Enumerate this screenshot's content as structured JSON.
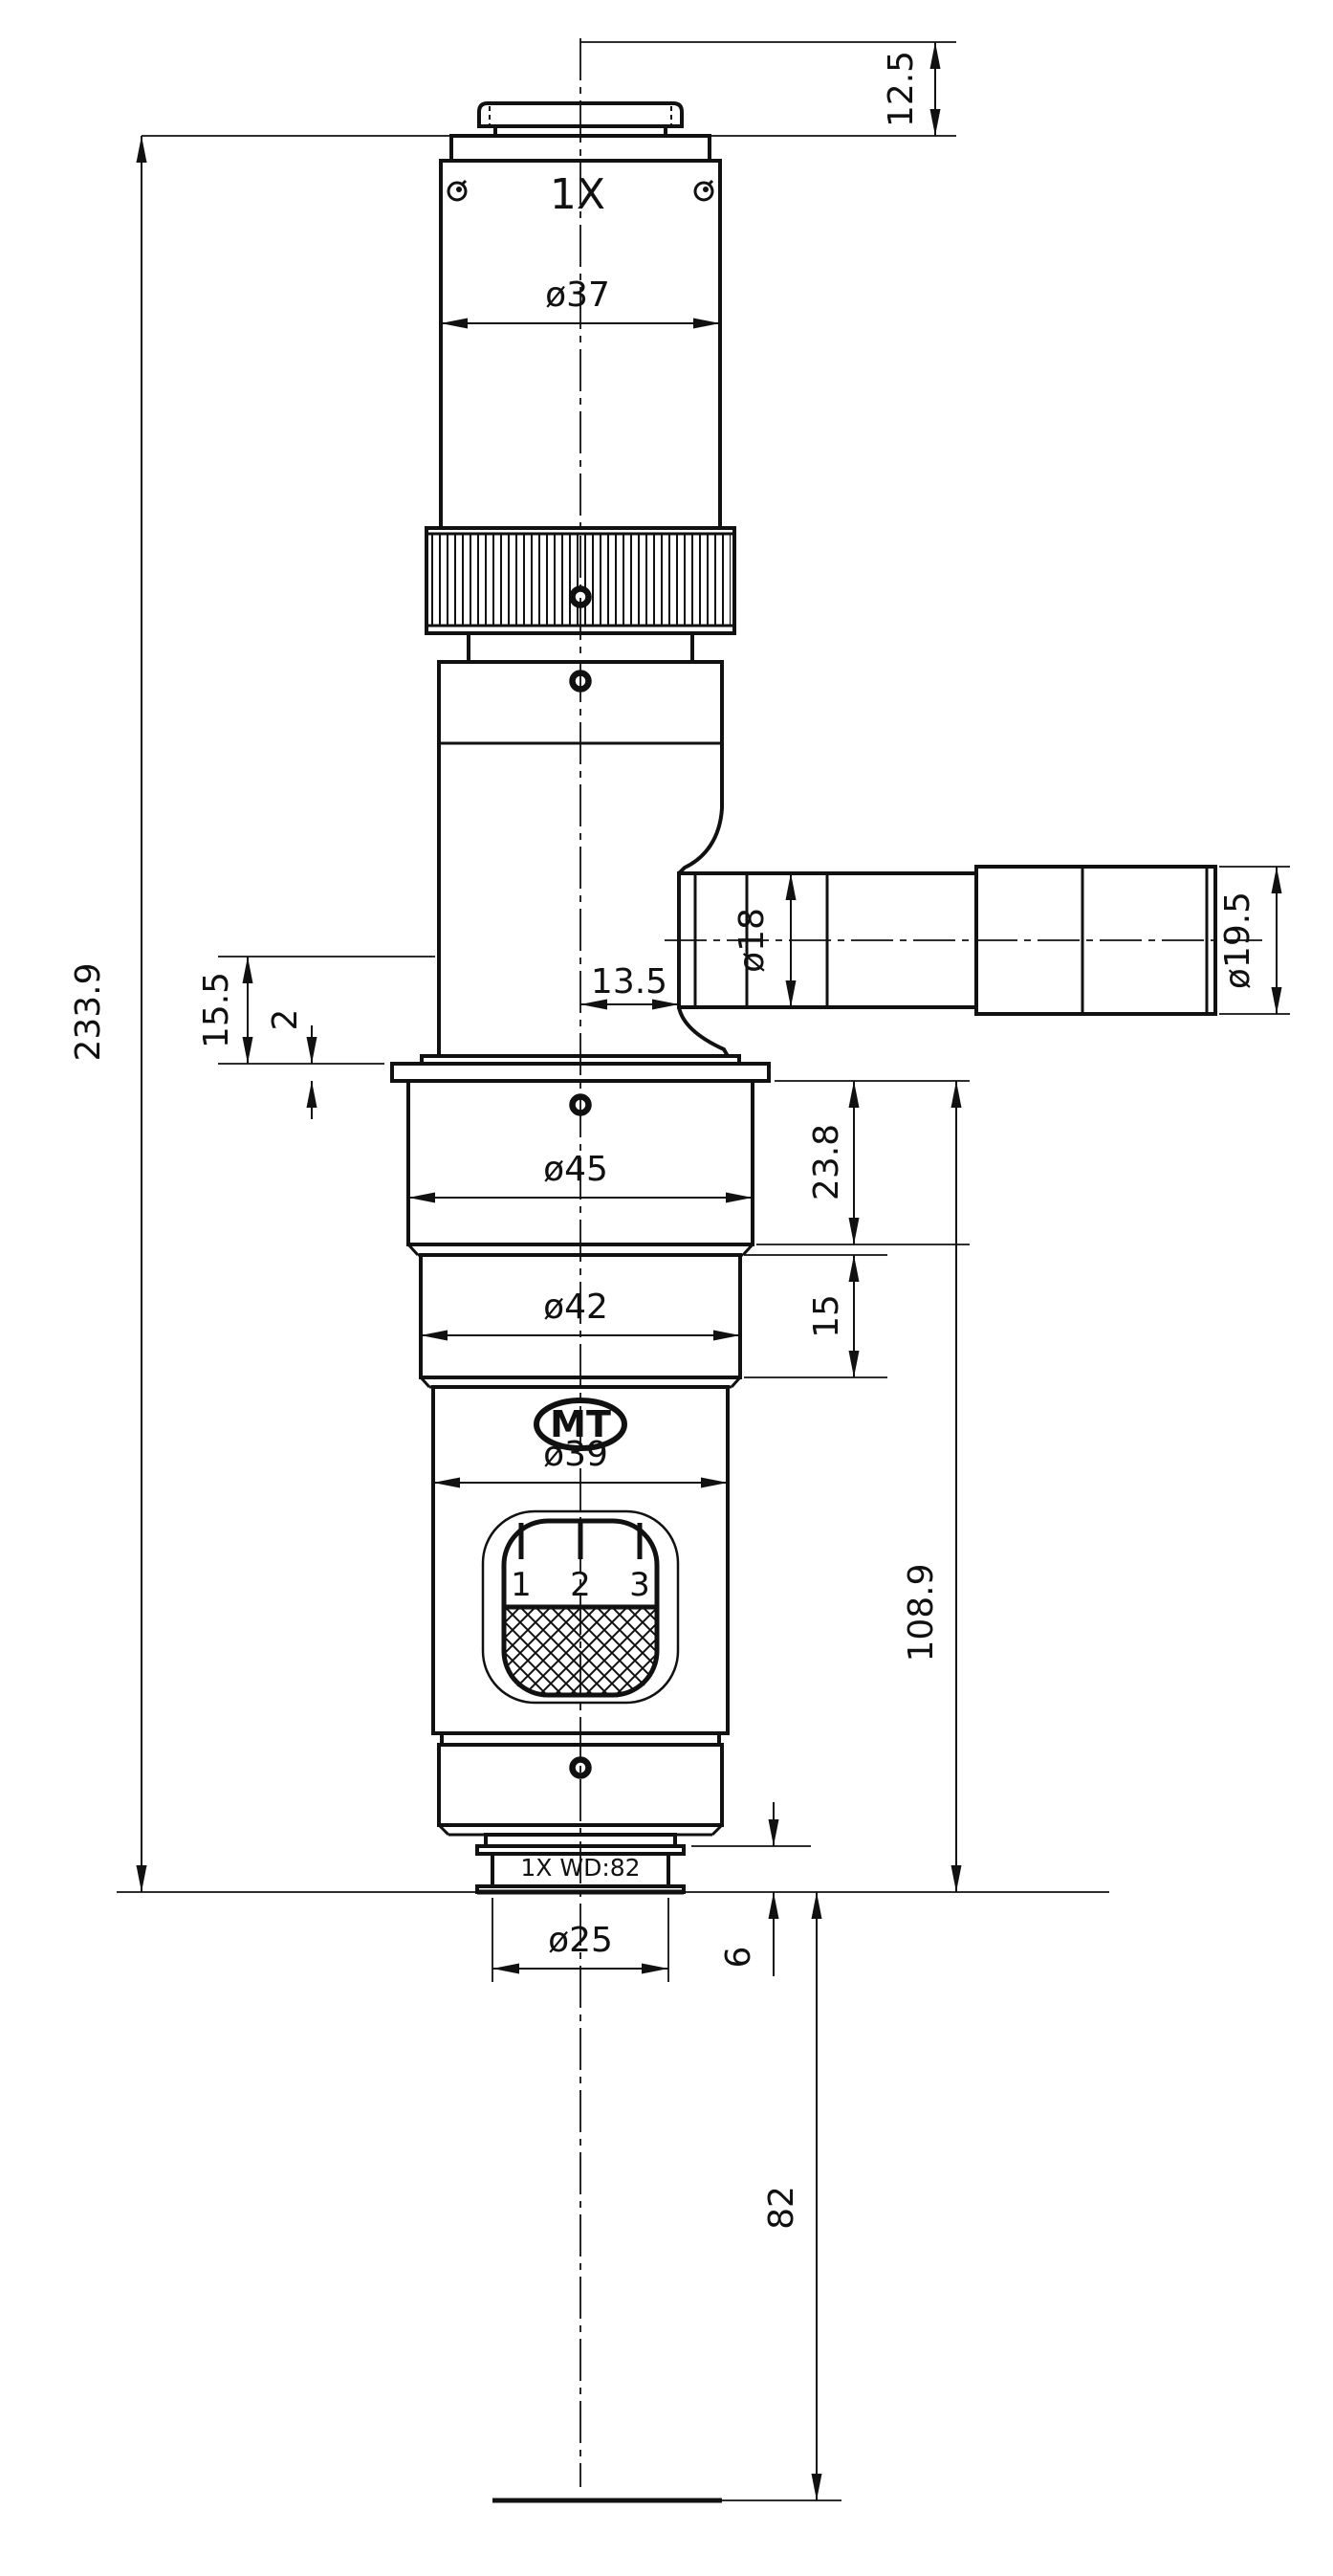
{
  "drawing": {
    "labels": {
      "magnification": "1X",
      "brand": "MT",
      "zoom_marks": [
        "1",
        "2",
        "3"
      ],
      "objective": "1X WD:82"
    },
    "dims": {
      "top_offset": "12.5",
      "overall_height": "233.9",
      "tube_dia": "ø37",
      "port_offset": "13.5",
      "port_dia": "ø18",
      "port_end_dia": "ø19.5",
      "flange_drop": "15.5",
      "flange_step": "2",
      "upper_dia": "ø45",
      "upper_h": "23.8",
      "mid_dia": "ø42",
      "mid_h": "15",
      "lower_dia": "ø39",
      "lower_h": "108.9",
      "lens_dia": "ø25",
      "lens_protrusion": "6",
      "working_distance": "82"
    },
    "colors": {
      "ink": "#111111",
      "paper": "#ffffff"
    }
  }
}
